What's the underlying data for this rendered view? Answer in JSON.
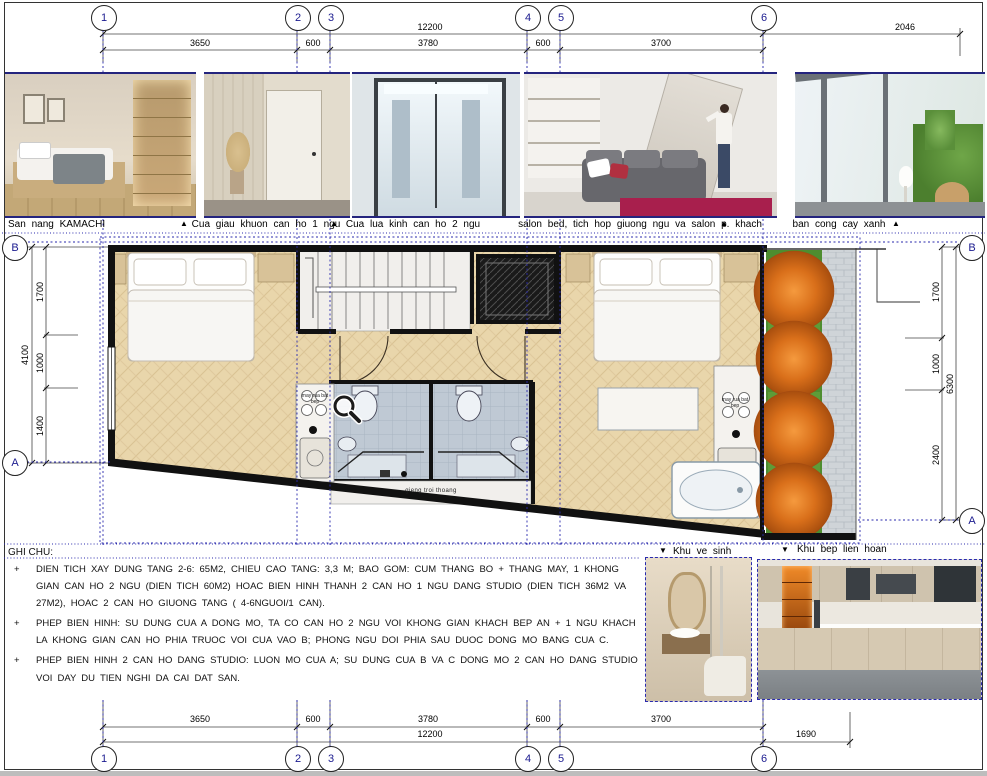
{
  "sheet": {
    "grid_top": [
      "1",
      "2",
      "3",
      "4",
      "5",
      "6"
    ],
    "grid_bottom": [
      "1",
      "2",
      "3",
      "4",
      "5",
      "6"
    ],
    "grid_left": [
      "B",
      "A"
    ],
    "grid_right": [
      "B",
      "A"
    ]
  },
  "dims": {
    "top": {
      "total": "12200",
      "right": "2046",
      "segs": [
        "3650",
        "600",
        "3780",
        "600",
        "3700"
      ]
    },
    "bottom": {
      "total": "12200",
      "right": "1690",
      "segs": [
        "3650",
        "600",
        "3780",
        "600",
        "3700"
      ]
    },
    "left": {
      "total": "4100",
      "segs": [
        "1700",
        "1000",
        "1400"
      ]
    },
    "right": {
      "total": "6300",
      "segs": [
        "1700",
        "1000",
        "2400"
      ]
    }
  },
  "captions": {
    "photo1": "San nang KAMACHI",
    "photo2": "Cua giau khuon can ho 1 ngu",
    "photo3": "Cua lua kinh can ho 2 ngu",
    "photo4": "salon bed, tich hop giuong ngu va salon p. khach",
    "photo5": "ban cong cay xanh",
    "bathroom": "Khu ve sinh",
    "kitchen": "Khu bep lien hoan",
    "up_arrow": "▲",
    "down_arrow": "▼"
  },
  "notes": {
    "title": "GHI CHU:",
    "bullet": "+",
    "items": [
      "DIEN TICH XAY DUNG TANG 2-6: 65M2, CHIEU CAO TANG: 3,3 M; BAO GOM: CUM THANG BO + THANG MAY, 1 KHONG GIAN CAN HO 2 NGU (DIEN TICH 60M2) HOAC BIEN HINH THANH 2 CAN HO 1 NGU DANG STUDIO (DIEN TICH 36M2 VA 27M2), HOAC 2 CAN HO GIUONG TANG ( 4-6NGUOI/1 CAN).",
      "PHEP BIEN HINH: SU DUNG CUA A DONG MO, TA CO CAN HO 2 NGU VOI KHONG GIAN KHACH BEP AN + 1 NGU KHACH LA KHONG GIAN CAN HO PHIA TRUOC VOI CUA VAO B; PHONG NGU DOI PHIA SAU DUOC DONG MO BANG CUA C.",
      "PHEP BIEN HINH 2 CAN HO DANG STUDIO: LUON MO CUA A; SU DUNG CUA B VA C DONG MO 2 CAN HO DANG STUDIO VOI DAY DU TIEN NGHI DA CAI DAT SAN."
    ]
  },
  "plan": {
    "lightwell_label": "gieng troi thoang",
    "kitchen_label_left": "may rua bat bep",
    "kitchen_label_right": "may rua bat bep"
  },
  "colors": {
    "grid_blue": "#2a2aad",
    "photo_border": "#24247e",
    "wall_black": "#111111",
    "wood": "#e9d6ab",
    "grass": "#4e8d2f",
    "tree_orange": "#d96f1a"
  }
}
